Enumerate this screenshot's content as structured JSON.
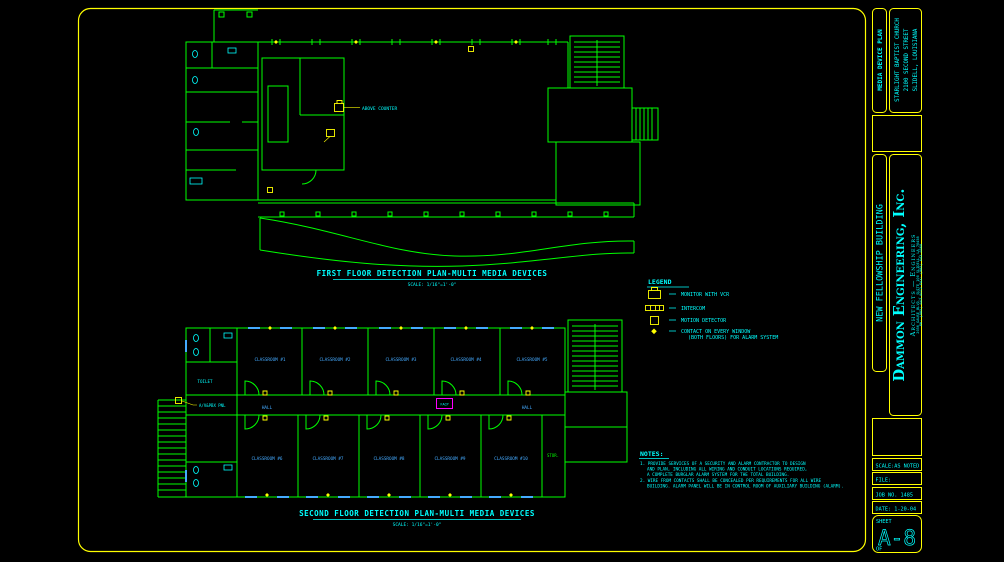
{
  "sheet": {
    "titleblock": {
      "media_plan": "MEDIA DEVICE PLAN",
      "project_line1": "STARLIGHT BAPTIST CHURCH",
      "project_line2": "2100 SECOND STREET",
      "project_line3": "SLIDELL, LOUISIANA",
      "building": "NEW FELLOWSHIP BUILDING",
      "firm_name": "Dammon Engineering, Inc.",
      "firm_type": "Architects — Engineers",
      "firm_addr1": "2056 GAUSE BLVD., SUITE 100  SLIDELL, LA 70458",
      "firm_addr2": "PH: (985) 643-0072   FAX: (985) 643-0560",
      "scale": "SCALE:AS NOTED",
      "file": "FILE:",
      "job": "JOB NO. 1485",
      "date": "DATE: 1-20-04",
      "sheet_label": "SHEET",
      "sheet_number": "A-8",
      "of_label": "OF"
    }
  },
  "plans": {
    "first": {
      "title": "FIRST FLOOR DETECTION PLAN-MULTI MEDIA DEVICES",
      "scale": "SCALE: 1/16\"=1'-0\"",
      "above_counter": "ABOVE COUNTER"
    },
    "second": {
      "title": "SECOND FLOOR DETECTION PLAN-MULTI MEDIA DEVICES",
      "scale": "SCALE: 1/16\"=1'-0\"",
      "rooms_top": [
        "CLASSROOM #1",
        "CLASSROOM #2",
        "CLASSROOM #3",
        "CLASSROOM #4",
        "CLASSROOM #5"
      ],
      "rooms_bottom": [
        "CLASSROOM #6",
        "CLASSROOM #7",
        "CLASSROOM #8",
        "CLASSROOM #9",
        "CLASSROOM #10"
      ],
      "av_pbx": "A/V&PBX PNL",
      "hall_left": "HALL",
      "hall_right": "HALL",
      "toilet": "TOILET",
      "stor": "STOR.",
      "panel": "FACP"
    }
  },
  "legend": {
    "title": "LEGEND",
    "items": [
      {
        "icon": "monitor-vcr-icon",
        "label": "MONITOR WITH VCR"
      },
      {
        "icon": "intercom-icon",
        "label": "INTERCOM"
      },
      {
        "icon": "motion-detector-icon",
        "label": "MOTION DETECTOR"
      },
      {
        "icon": "window-contact-icon",
        "label": "CONTACT ON EVERY WINDOW",
        "label2": "(BOTH FLOORS) FOR ALARM SYSTEM"
      }
    ]
  },
  "notes": {
    "title": "NOTES:",
    "lines": [
      "1. PROVIDE SERVICES OF A SECURITY AND ALARM CONTRACTOR TO DESIGN",
      "AND PLAN, INCLUDING ALL WIRING AND CONDUIT LOCATIONS REQUIRED,",
      "A COMPLETE BURGLAR ALARM SYSTEM FOR THE TOTAL BUILDING.",
      "2. WIRE FROM CONTACTS SHALL BE CONCEALED PER REQUIREMENTS FOR ALL WIRE",
      "BUILDING.  ALARM PANEL WILL BE IN CONTROL ROOM OF AUXILIARY BUILDING (ALARM)."
    ]
  },
  "colors": {
    "walls_green": "#00ff00",
    "annotation_cyan": "#00ffff",
    "device_yellow": "#ffff00",
    "label_blue": "#44aaff",
    "panel_magenta": "#ff00ff",
    "background": "#000000"
  }
}
